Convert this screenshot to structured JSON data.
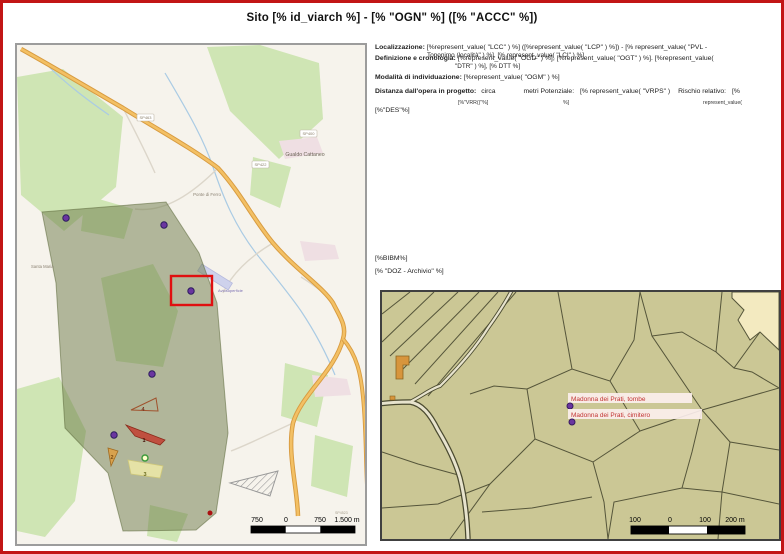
{
  "title": "Sito [% id_viarch %] - [% \"OGN\" %] ([% \"ACCC\" %])",
  "info": {
    "loc_label": "Localizzazione:",
    "loc_text": "[%represent_value( \"LCC\" ) %] ([%represent_value( \"LCP\" )  %]) - [% represent_value(  \"PVL -",
    "loc_overflow": "Toponimo (località\" ) %], [% represent_value( \"LCI\" ) %]",
    "def_label": "Definizione e cronologia:",
    "def_text": "[%represent_value( \"OGD\" ) %], [%represent_value( \"OGT\" )  %]. [%represent_value(",
    "def_overflow": "\"DTR\" )  %], [% DTT %]",
    "mod_label": "Modalità di individuazione:",
    "mod_text": "[%represent_value( \"OGM\" ) %]",
    "dist_label": "Distanza dall'opera in progetto:",
    "dist_circa": "circa",
    "dist_metri": "metri Potenziale:",
    "dist_vrps": "[%  represent_value(  \"VRPS\"  )",
    "dist_rischio": "Rischio relativo:",
    "dist_open": "[%",
    "dist_small_vrr": "[%\"VRR()\"%]",
    "dist_small_close": "%]",
    "dist_small_rv": "represent_value(",
    "des": "[%\"DES\"%]",
    "bibm": "[%BIBM%]",
    "doz": "[% \"DOZ - Archivio\" %]"
  },
  "map1": {
    "town": "Gualdo Cattaneo",
    "place1": "Ponte di Ferro",
    "place2": "Santa Maria",
    "airstrip": "Aviosuperficie",
    "shield1": "SP463",
    "shield2": "SP422",
    "shield3": "SP400",
    "shield4": "SP4523",
    "n1": "1",
    "n2": "2",
    "n3": "3",
    "n4": "4",
    "scale": {
      "t0": "750",
      "t1": "0",
      "t2": "750",
      "t3": "1.500 m"
    }
  },
  "map2": {
    "label_tombe": "Madonna dei Prati, tombe",
    "label_cimitero": "Madonna dei Prati, cimitero",
    "scale": {
      "t0": "100",
      "t1": "0",
      "t2": "100",
      "t3": "200 m"
    }
  },
  "colors": {
    "page_border": "#c21515",
    "survey_overlay": "#6c7a48",
    "highlight_rect": "#e01010",
    "marker_purple": "#6a35a0",
    "feature_red": "#c05040",
    "feature_orange": "#d8a24e",
    "feature_yellow": "#eeeaa8",
    "cadastre_bg": "#cbc795",
    "label_red": "#c23333"
  }
}
